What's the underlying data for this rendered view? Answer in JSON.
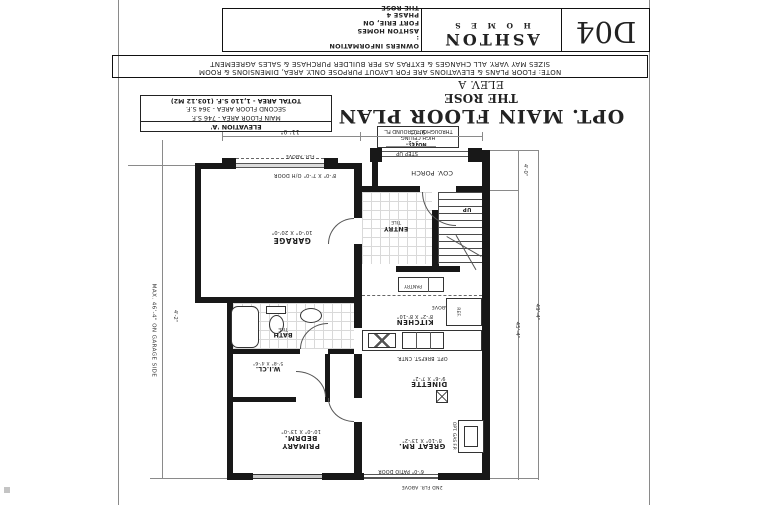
{
  "sheet": {
    "title_block": {
      "code": "D04",
      "brand1": "ASHTON",
      "brand2": "H O M E S",
      "owners_heading": "OWNERS INFORMATION :",
      "owners": [
        "ASHTON HOMES",
        "FORT ERIE, ON",
        "PHASE 4",
        "THE ROSE"
      ]
    },
    "disclaimer": {
      "l1": "NOTE: FLOOR PLANS & ELEVATIONS ARE FOR LAYOUT PURPOSE ONLY. AREA, DIMENSIONS & ROOM",
      "l2": "SIZES MAY VARY. ALL CHANGES & EXTRAS AS PER BUILDER PURCHASE & SALES AGREEMENT"
    }
  },
  "title": {
    "main": "OPT. MAIN FLOOR PLAN",
    "model": "THE ROSE",
    "elevation": "ELEV. A"
  },
  "area_table": {
    "heading": "ELEVATION 'A'",
    "rows": [
      "MAIN FLOOR AREA - 746 S.F.",
      "SECOND FLOOR AREA - 364 S.F.",
      "TOTAL AREA - 1,110 S.F. (103.12 M2)"
    ]
  },
  "ceiling_note": {
    "l1": "NOTE:",
    "l2": "HIGH CEILING",
    "l3": "THROUGHOUT GROUND FL."
  },
  "rooms": {
    "porch": {
      "name": "COV. PORCH"
    },
    "entry": {
      "name": "ENTRY",
      "finish": "TILE"
    },
    "garage": {
      "name": "GARAGE",
      "dims": "10'-0\" X 20'-0\""
    },
    "kitchen": {
      "name": "KITCHEN",
      "dims": "8'-2\" X 8'-10\""
    },
    "dinette": {
      "name": "DINETTE",
      "dims": "9'-6\" X 7'-2\""
    },
    "great_room": {
      "name": "GREAT RM.",
      "dims": "8'-10\" X 13'-2\""
    },
    "bath": {
      "name": "BATH",
      "finish": "TILE"
    },
    "wicl": {
      "name": "W.I.CL.",
      "dims": "5'-8\" X 4'-6\""
    },
    "primary": {
      "name": "PRIMARY BEDRM.",
      "dims": "10'-0\" X 13'-0\""
    }
  },
  "annotations": {
    "step_up": "STEP UP",
    "oh_door": "8'-0\" X 7'-0\" O/H DOOR",
    "flr_above": "FLR. ABOVE",
    "ref": "REF.",
    "brkfst": "OPT. BRKFST. CNTR.",
    "gas_fp": "OPT. GAS F.P.",
    "patio_door": "6'-0\" PATIO DOOR",
    "second_flr": "2ND FLR. ABOVE",
    "pantry": "PANTRY",
    "up": "UP"
  },
  "dimensions": {
    "d_11_0": "11'-0\"",
    "d_9_0": "9'-0\"",
    "d_5_2": "5'-2\"",
    "d_4_0": "4'-0\"",
    "d_45_4": "45'-4\"",
    "d_49_4": "49'-4\"",
    "d_4_2": "4'-2\"",
    "garage_side_note": "MAX. 46'-4\" ON GARAGE SIDE"
  }
}
